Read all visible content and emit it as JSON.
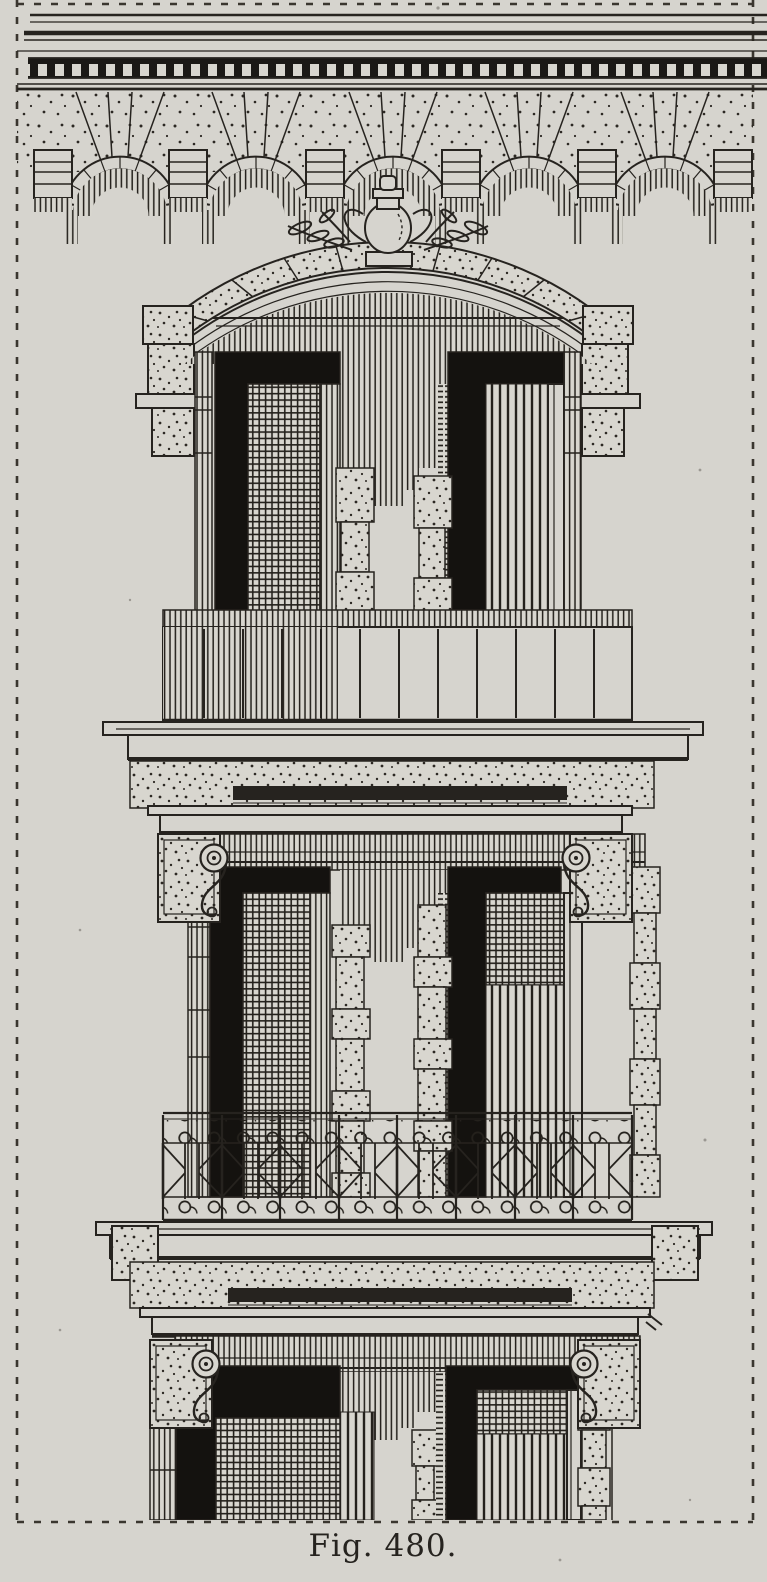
{
  "figure": {
    "caption": "Fig. 480."
  },
  "colors": {
    "paper": "#d6d4ce",
    "ink": "#26231f",
    "deep_shadow": "#14120f"
  }
}
